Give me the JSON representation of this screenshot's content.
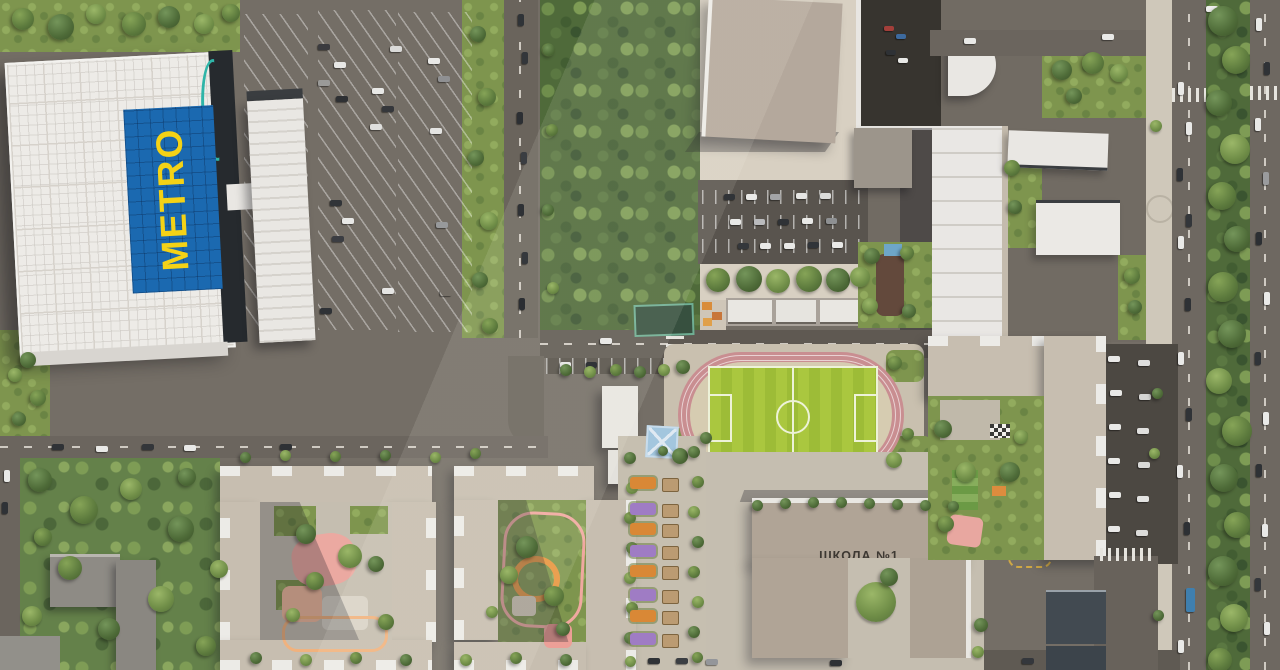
{
  "scene": {
    "type": "aerial-masterplan-render",
    "labels": {
      "metro": "METRO",
      "school": "ШКОЛА №1"
    },
    "palette": {
      "metro_sign_blue": "#1b69b0",
      "metro_sign_yellow": "#f4d216",
      "metro_roof_white": "#edebe7",
      "asphalt": "#6b655e",
      "dark_parking": "#59544e",
      "forest_green": "#4f6a3a",
      "grass_green": "#7e954e",
      "pitch_green": "#a7c642",
      "track_pink": "#c98e91",
      "stand_blue": "#7e9cbb",
      "roof_beige": "#c7beb0",
      "school_roof": "#b0a496",
      "playground_pink": "#eba9a1",
      "playground_orange": "#e8963f",
      "bed_orange": "#d98836",
      "bed_purple": "#9f7cc4",
      "entrance_teal": "#2fb5a8"
    }
  },
  "sprites": {
    "cars": [
      [
        318,
        44,
        12,
        6,
        "#3b3b3f"
      ],
      [
        334,
        62,
        12,
        6,
        "#e8e8e6"
      ],
      [
        318,
        80,
        12,
        6,
        "#9a9a98"
      ],
      [
        336,
        96,
        12,
        6,
        "#2e3033"
      ],
      [
        372,
        88,
        12,
        6,
        "#e8e8e6"
      ],
      [
        382,
        106,
        12,
        6,
        "#35373b"
      ],
      [
        370,
        124,
        12,
        6,
        "#dfdfdd"
      ],
      [
        390,
        46,
        12,
        6,
        "#dadad8"
      ],
      [
        428,
        58,
        12,
        6,
        "#e8e8e6"
      ],
      [
        438,
        76,
        12,
        6,
        "#8f9092"
      ],
      [
        430,
        128,
        12,
        6,
        "#e4e4e2"
      ],
      [
        330,
        200,
        12,
        6,
        "#313438"
      ],
      [
        342,
        218,
        12,
        6,
        "#e8e8e6"
      ],
      [
        332,
        236,
        12,
        6,
        "#3b3d42"
      ],
      [
        436,
        222,
        12,
        6,
        "#97999b"
      ],
      [
        382,
        288,
        12,
        6,
        "#e6e6e4"
      ],
      [
        440,
        290,
        12,
        6,
        "#ecetheir"
      ],
      [
        320,
        308,
        12,
        6,
        "#2f3236"
      ],
      [
        518,
        14,
        6,
        12,
        "#2f3337"
      ],
      [
        522,
        52,
        6,
        12,
        "#33363a"
      ],
      [
        517,
        112,
        6,
        12,
        "#2c2f33"
      ],
      [
        521,
        152,
        6,
        12,
        "#3a3d41"
      ],
      [
        518,
        204,
        6,
        12,
        "#2e3135"
      ],
      [
        522,
        252,
        6,
        12,
        "#35383c"
      ],
      [
        519,
        298,
        6,
        12,
        "#2b2e32"
      ],
      [
        724,
        194,
        11,
        6,
        "#303337"
      ],
      [
        746,
        194,
        11,
        6,
        "#e9e9e7"
      ],
      [
        770,
        194,
        11,
        6,
        "#a3a4a6"
      ],
      [
        796,
        193,
        11,
        6,
        "#e6e6e4"
      ],
      [
        820,
        193,
        11,
        6,
        "#dcdcda"
      ],
      [
        730,
        219,
        11,
        6,
        "#e9e9e7"
      ],
      [
        754,
        219,
        11,
        6,
        "#babbbd"
      ],
      [
        778,
        219,
        11,
        6,
        "#2f3236"
      ],
      [
        802,
        218,
        11,
        6,
        "#e9e9e7"
      ],
      [
        826,
        218,
        11,
        6,
        "#8e9092"
      ],
      [
        738,
        243,
        11,
        6,
        "#34373b"
      ],
      [
        760,
        243,
        11,
        6,
        "#e9e9e7"
      ],
      [
        784,
        243,
        11,
        6,
        "#e9e9e7"
      ],
      [
        808,
        242,
        11,
        6,
        "#303439"
      ],
      [
        832,
        242,
        11,
        6,
        "#e9e9e7"
      ],
      [
        884,
        26,
        10,
        5,
        "#a33f3a"
      ],
      [
        896,
        34,
        10,
        5,
        "#3d6a9e"
      ],
      [
        886,
        50,
        10,
        5,
        "#2e3135"
      ],
      [
        898,
        58,
        10,
        5,
        "#e8e8e6"
      ],
      [
        964,
        38,
        12,
        6,
        "#e9e9e7"
      ],
      [
        1102,
        34,
        12,
        6,
        "#e9e9e7"
      ],
      [
        1206,
        6,
        12,
        6,
        "#eeeeec"
      ],
      [
        1178,
        82,
        6,
        13,
        "#e9e9e7"
      ],
      [
        1186,
        122,
        6,
        13,
        "#e9e9e7"
      ],
      [
        1177,
        168,
        6,
        13,
        "#2f3236"
      ],
      [
        1186,
        214,
        6,
        13,
        "#33363a"
      ],
      [
        1178,
        236,
        6,
        13,
        "#e9e9e7"
      ],
      [
        1185,
        298,
        6,
        13,
        "#2e3135"
      ],
      [
        1178,
        352,
        6,
        13,
        "#e9e9e7"
      ],
      [
        1186,
        408,
        6,
        13,
        "#303337"
      ],
      [
        1177,
        465,
        6,
        13,
        "#e9e9e7"
      ],
      [
        1184,
        522,
        6,
        13,
        "#2d3034"
      ],
      [
        1178,
        640,
        6,
        13,
        "#e9e9e7"
      ],
      [
        1186,
        588,
        9,
        24,
        "#3f7fae"
      ],
      [
        1256,
        18,
        6,
        13,
        "#e9e9e7"
      ],
      [
        1264,
        62,
        6,
        13,
        "#2f3236"
      ],
      [
        1255,
        118,
        6,
        13,
        "#e9e9e7"
      ],
      [
        1263,
        172,
        6,
        13,
        "#9a9b9d"
      ],
      [
        1256,
        232,
        6,
        13,
        "#2c2f33"
      ],
      [
        1264,
        292,
        6,
        13,
        "#e9e9e7"
      ],
      [
        1255,
        352,
        6,
        13,
        "#303338"
      ],
      [
        1263,
        412,
        6,
        13,
        "#e9e9e7"
      ],
      [
        1256,
        464,
        6,
        13,
        "#2e3135"
      ],
      [
        1262,
        524,
        6,
        13,
        "#e9e9e7"
      ],
      [
        1255,
        578,
        6,
        13,
        "#34373b"
      ],
      [
        1264,
        622,
        6,
        13,
        "#e9e9e7"
      ],
      [
        1108,
        356,
        12,
        6,
        "#e9e9e7"
      ],
      [
        1138,
        360,
        12,
        6,
        "#dededd"
      ],
      [
        1110,
        390,
        12,
        6,
        "#e9e9e7"
      ],
      [
        1139,
        394,
        12,
        6,
        "#d5d5d3"
      ],
      [
        1109,
        424,
        12,
        6,
        "#e9e9e7"
      ],
      [
        1137,
        428,
        12,
        6,
        "#e0e0de"
      ],
      [
        1108,
        458,
        12,
        6,
        "#e9e9e7"
      ],
      [
        1138,
        462,
        12,
        6,
        "#d8d8d6"
      ],
      [
        1109,
        492,
        12,
        6,
        "#e9e9e7"
      ],
      [
        1137,
        496,
        12,
        6,
        "#e3e3e1"
      ],
      [
        1108,
        526,
        12,
        6,
        "#e9e9e7"
      ],
      [
        1136,
        530,
        12,
        6,
        "#dcdcda"
      ],
      [
        600,
        338,
        12,
        6,
        "#e9e9e7"
      ],
      [
        560,
        362,
        11,
        6,
        "#e9e9e7"
      ],
      [
        586,
        362,
        11,
        6,
        "#303337"
      ],
      [
        52,
        444,
        12,
        6,
        "#2f3236"
      ],
      [
        96,
        446,
        12,
        6,
        "#e9e9e7"
      ],
      [
        142,
        444,
        12,
        6,
        "#33363a"
      ],
      [
        184,
        445,
        12,
        6,
        "#e9e9e7"
      ],
      [
        280,
        444,
        12,
        6,
        "#2e3135"
      ],
      [
        648,
        658,
        12,
        6,
        "#2f3236"
      ],
      [
        676,
        658,
        12,
        6,
        "#3b3e42"
      ],
      [
        706,
        659,
        12,
        6,
        "#94969a"
      ],
      [
        830,
        660,
        12,
        6,
        "#2e3135"
      ],
      [
        1022,
        658,
        12,
        6,
        "#34373c"
      ],
      [
        4,
        470,
        6,
        12,
        "#e9e9e7"
      ],
      [
        2,
        502,
        6,
        12,
        "#2f3236"
      ]
    ],
    "trees": [
      [
        12,
        8,
        22,
        0
      ],
      [
        48,
        14,
        26,
        1
      ],
      [
        86,
        4,
        20,
        2
      ],
      [
        122,
        12,
        24,
        0
      ],
      [
        158,
        6,
        22,
        1
      ],
      [
        194,
        14,
        20,
        2
      ],
      [
        222,
        4,
        18,
        0
      ],
      [
        470,
        26,
        16,
        1
      ],
      [
        478,
        88,
        18,
        0
      ],
      [
        468,
        150,
        16,
        1
      ],
      [
        480,
        212,
        18,
        2
      ],
      [
        472,
        272,
        16,
        1
      ],
      [
        482,
        318,
        16,
        0
      ],
      [
        543,
        44,
        12,
        1
      ],
      [
        546,
        124,
        12,
        0
      ],
      [
        542,
        204,
        12,
        1
      ],
      [
        547,
        282,
        12,
        2
      ],
      [
        706,
        268,
        24,
        0
      ],
      [
        736,
        266,
        26,
        1
      ],
      [
        766,
        269,
        24,
        2
      ],
      [
        796,
        266,
        26,
        0
      ],
      [
        826,
        268,
        24,
        1
      ],
      [
        850,
        267,
        20,
        2
      ],
      [
        864,
        248,
        16,
        1
      ],
      [
        900,
        246,
        14,
        0
      ],
      [
        862,
        298,
        16,
        2
      ],
      [
        902,
        304,
        14,
        1
      ],
      [
        1052,
        60,
        20,
        1
      ],
      [
        1082,
        52,
        22,
        0
      ],
      [
        1110,
        64,
        18,
        2
      ],
      [
        1066,
        88,
        16,
        1
      ],
      [
        1004,
        160,
        16,
        0
      ],
      [
        1008,
        200,
        14,
        1
      ],
      [
        1124,
        268,
        16,
        0
      ],
      [
        1128,
        300,
        14,
        1
      ],
      [
        1208,
        6,
        30,
        1
      ],
      [
        1222,
        46,
        28,
        0
      ],
      [
        1206,
        90,
        26,
        1
      ],
      [
        1220,
        134,
        30,
        2
      ],
      [
        1208,
        182,
        28,
        0
      ],
      [
        1224,
        226,
        26,
        1
      ],
      [
        1208,
        272,
        30,
        0
      ],
      [
        1218,
        320,
        28,
        1
      ],
      [
        1206,
        368,
        26,
        2
      ],
      [
        1222,
        416,
        30,
        0
      ],
      [
        1210,
        464,
        28,
        1
      ],
      [
        1224,
        512,
        26,
        0
      ],
      [
        1208,
        556,
        30,
        1
      ],
      [
        1220,
        604,
        28,
        2
      ],
      [
        1208,
        648,
        24,
        0
      ],
      [
        1150,
        120,
        12,
        2
      ],
      [
        1152,
        388,
        11,
        1
      ],
      [
        1149,
        448,
        11,
        2
      ],
      [
        1153,
        610,
        11,
        1
      ],
      [
        676,
        360,
        14,
        1
      ],
      [
        888,
        356,
        14,
        0
      ],
      [
        672,
        448,
        16,
        1
      ],
      [
        886,
        452,
        16,
        2
      ],
      [
        902,
        428,
        12,
        0
      ],
      [
        752,
        500,
        11,
        1
      ],
      [
        780,
        498,
        11,
        1
      ],
      [
        808,
        497,
        11,
        1
      ],
      [
        836,
        497,
        11,
        1
      ],
      [
        864,
        498,
        11,
        1
      ],
      [
        892,
        499,
        11,
        1
      ],
      [
        920,
        500,
        11,
        1
      ],
      [
        948,
        501,
        11,
        1
      ],
      [
        856,
        582,
        40,
        2
      ],
      [
        880,
        568,
        18,
        1
      ],
      [
        974,
        618,
        14,
        1
      ],
      [
        972,
        646,
        12,
        2
      ],
      [
        934,
        420,
        18,
        1
      ],
      [
        956,
        462,
        20,
        2
      ],
      [
        938,
        516,
        16,
        0
      ],
      [
        1000,
        462,
        20,
        1
      ],
      [
        1014,
        430,
        14,
        2
      ],
      [
        624,
        452,
        12,
        1
      ],
      [
        626,
        482,
        12,
        2
      ],
      [
        624,
        512,
        12,
        0
      ],
      [
        626,
        542,
        12,
        1
      ],
      [
        624,
        572,
        12,
        2
      ],
      [
        626,
        602,
        12,
        0
      ],
      [
        624,
        632,
        12,
        1
      ],
      [
        625,
        656,
        11,
        2
      ],
      [
        688,
        446,
        12,
        1
      ],
      [
        692,
        476,
        12,
        0
      ],
      [
        688,
        506,
        12,
        2
      ],
      [
        692,
        536,
        12,
        1
      ],
      [
        688,
        566,
        12,
        0
      ],
      [
        692,
        596,
        12,
        2
      ],
      [
        688,
        626,
        12,
        1
      ],
      [
        692,
        652,
        11,
        0
      ],
      [
        658,
        446,
        10,
        1
      ],
      [
        700,
        432,
        12,
        1
      ],
      [
        296,
        524,
        20,
        1
      ],
      [
        338,
        544,
        24,
        2
      ],
      [
        306,
        572,
        18,
        0
      ],
      [
        368,
        556,
        16,
        1
      ],
      [
        286,
        608,
        14,
        2
      ],
      [
        378,
        614,
        16,
        0
      ],
      [
        516,
        536,
        22,
        1
      ],
      [
        500,
        566,
        18,
        2
      ],
      [
        544,
        586,
        20,
        0
      ],
      [
        556,
        622,
        14,
        1
      ],
      [
        486,
        606,
        12,
        2
      ],
      [
        28,
        468,
        24,
        1
      ],
      [
        70,
        496,
        28,
        0
      ],
      [
        120,
        478,
        22,
        2
      ],
      [
        168,
        516,
        26,
        1
      ],
      [
        58,
        556,
        24,
        0
      ],
      [
        148,
        586,
        26,
        2
      ],
      [
        98,
        618,
        22,
        1
      ],
      [
        196,
        636,
        20,
        0
      ],
      [
        22,
        606,
        20,
        2
      ],
      [
        178,
        468,
        18,
        1
      ],
      [
        210,
        560,
        18,
        2
      ],
      [
        34,
        528,
        18,
        0
      ],
      [
        250,
        652,
        12,
        1
      ],
      [
        300,
        654,
        12,
        2
      ],
      [
        350,
        652,
        12,
        0
      ],
      [
        400,
        654,
        12,
        1
      ],
      [
        460,
        654,
        12,
        2
      ],
      [
        510,
        652,
        12,
        0
      ],
      [
        560,
        654,
        12,
        1
      ],
      [
        240,
        452,
        11,
        1
      ],
      [
        280,
        450,
        11,
        2
      ],
      [
        330,
        451,
        11,
        0
      ],
      [
        380,
        450,
        11,
        1
      ],
      [
        430,
        452,
        11,
        2
      ],
      [
        470,
        448,
        11,
        0
      ],
      [
        20,
        352,
        16,
        1
      ],
      [
        8,
        368,
        14,
        2
      ],
      [
        30,
        390,
        16,
        0
      ],
      [
        12,
        412,
        14,
        1
      ],
      [
        560,
        364,
        12,
        1
      ],
      [
        584,
        366,
        12,
        2
      ],
      [
        610,
        364,
        12,
        0
      ],
      [
        634,
        366,
        12,
        1
      ],
      [
        658,
        364,
        12,
        2
      ]
    ],
    "garden_beds": [
      [
        477,
        "#d98836"
      ],
      [
        503,
        "#9f7cc4"
      ],
      [
        523,
        "#d98836"
      ],
      [
        545,
        "#9f7cc4"
      ],
      [
        565,
        "#d98836"
      ],
      [
        589,
        "#9f7cc4"
      ],
      [
        610,
        "#d98836"
      ],
      [
        633,
        "#9f7cc4"
      ]
    ]
  }
}
